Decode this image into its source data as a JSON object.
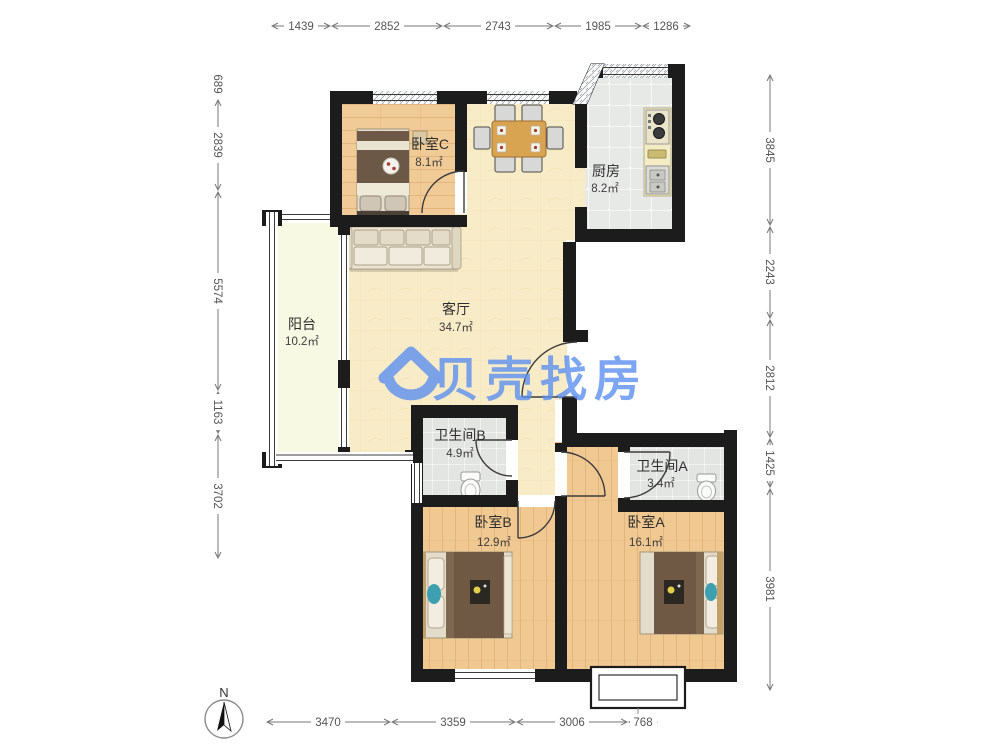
{
  "plan": {
    "watermark": {
      "brand": "贝壳找房",
      "color": "#5C8FF0"
    },
    "compass": {
      "north": "N"
    },
    "rooms": [
      {
        "key": "bedroom_c",
        "name": "卧室C",
        "area": "8.1㎡"
      },
      {
        "key": "kitchen",
        "name": "厨房",
        "area": "8.2㎡"
      },
      {
        "key": "living",
        "name": "客厅",
        "area": "34.7㎡"
      },
      {
        "key": "balcony",
        "name": "阳台",
        "area": "10.2㎡"
      },
      {
        "key": "bath_b",
        "name": "卫生间B",
        "area": "4.9㎡"
      },
      {
        "key": "bath_a",
        "name": "卫生间A",
        "area": "3.4㎡"
      },
      {
        "key": "bedroom_b",
        "name": "卧室B",
        "area": "12.9㎡"
      },
      {
        "key": "bedroom_a",
        "name": "卧室A",
        "area": "16.1㎡"
      }
    ],
    "dimensions_mm": {
      "top": [
        "1439",
        "2852",
        "2743",
        "1985",
        "1286"
      ],
      "left": [
        "689",
        "2839",
        "5574",
        "1163",
        "3702"
      ],
      "right": [
        "3845",
        "2243",
        "2812",
        "1425",
        "3981"
      ],
      "bottom": [
        "3470",
        "3359",
        "3006",
        "768"
      ]
    },
    "colors": {
      "wall": "#1C1C1C",
      "living_floor": "#F8EBC7",
      "wood_floor": "#F0C892",
      "tile_floor": "#E6E8E5",
      "balcony_floor": "#F7F9E3",
      "watermark_blue": "#5C8FF0"
    }
  }
}
